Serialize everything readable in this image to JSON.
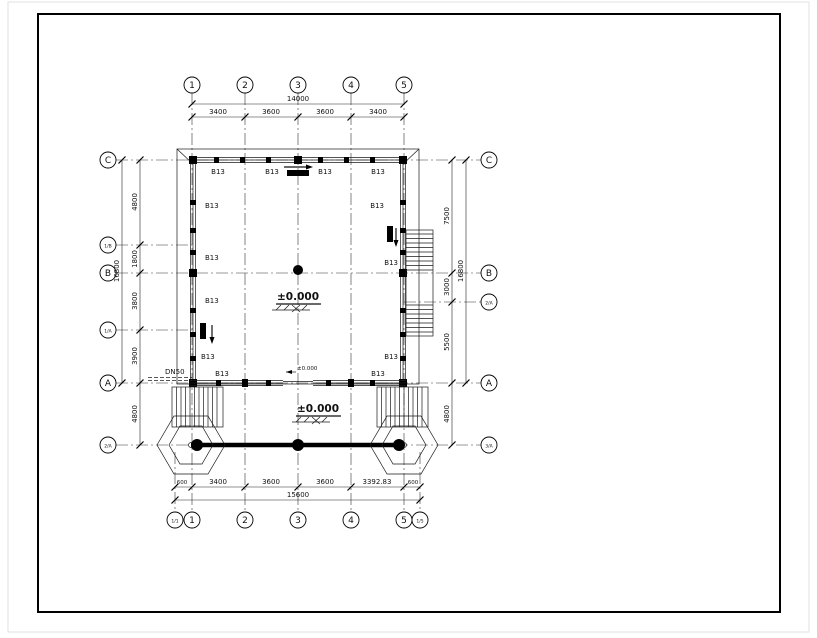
{
  "axes": {
    "top": [
      "1",
      "2",
      "3",
      "4",
      "5"
    ],
    "bottom": [
      "1",
      "2",
      "3",
      "4",
      "5"
    ],
    "bottom_sub_left": "1/1",
    "bottom_sub_right": "1/5",
    "left": [
      "C",
      "1/B",
      "B",
      "1/A",
      "A",
      "2/A"
    ],
    "right": [
      "C",
      "B",
      "2/A",
      "A",
      "3/A"
    ]
  },
  "dims": {
    "top_overall": "14000",
    "top_segs": [
      "3400",
      "3600",
      "3600",
      "3400"
    ],
    "bottom_segs": [
      "600",
      "3400",
      "3600",
      "3600",
      "3392.83",
      "600"
    ],
    "bottom_overall": "15600",
    "left_segs": [
      "4800",
      "1800",
      "3800",
      "3900"
    ],
    "left_overall": "16800",
    "left_porch": "4800",
    "right_segs": [
      "7500",
      "3000",
      "5500"
    ],
    "right_overall": "16800",
    "right_porch": "4800"
  },
  "labels": {
    "wall_tag": "B13",
    "pipe": "DN50",
    "level_main": "±0.000",
    "level_porch": "±0.000",
    "level_door": "±0.000"
  }
}
